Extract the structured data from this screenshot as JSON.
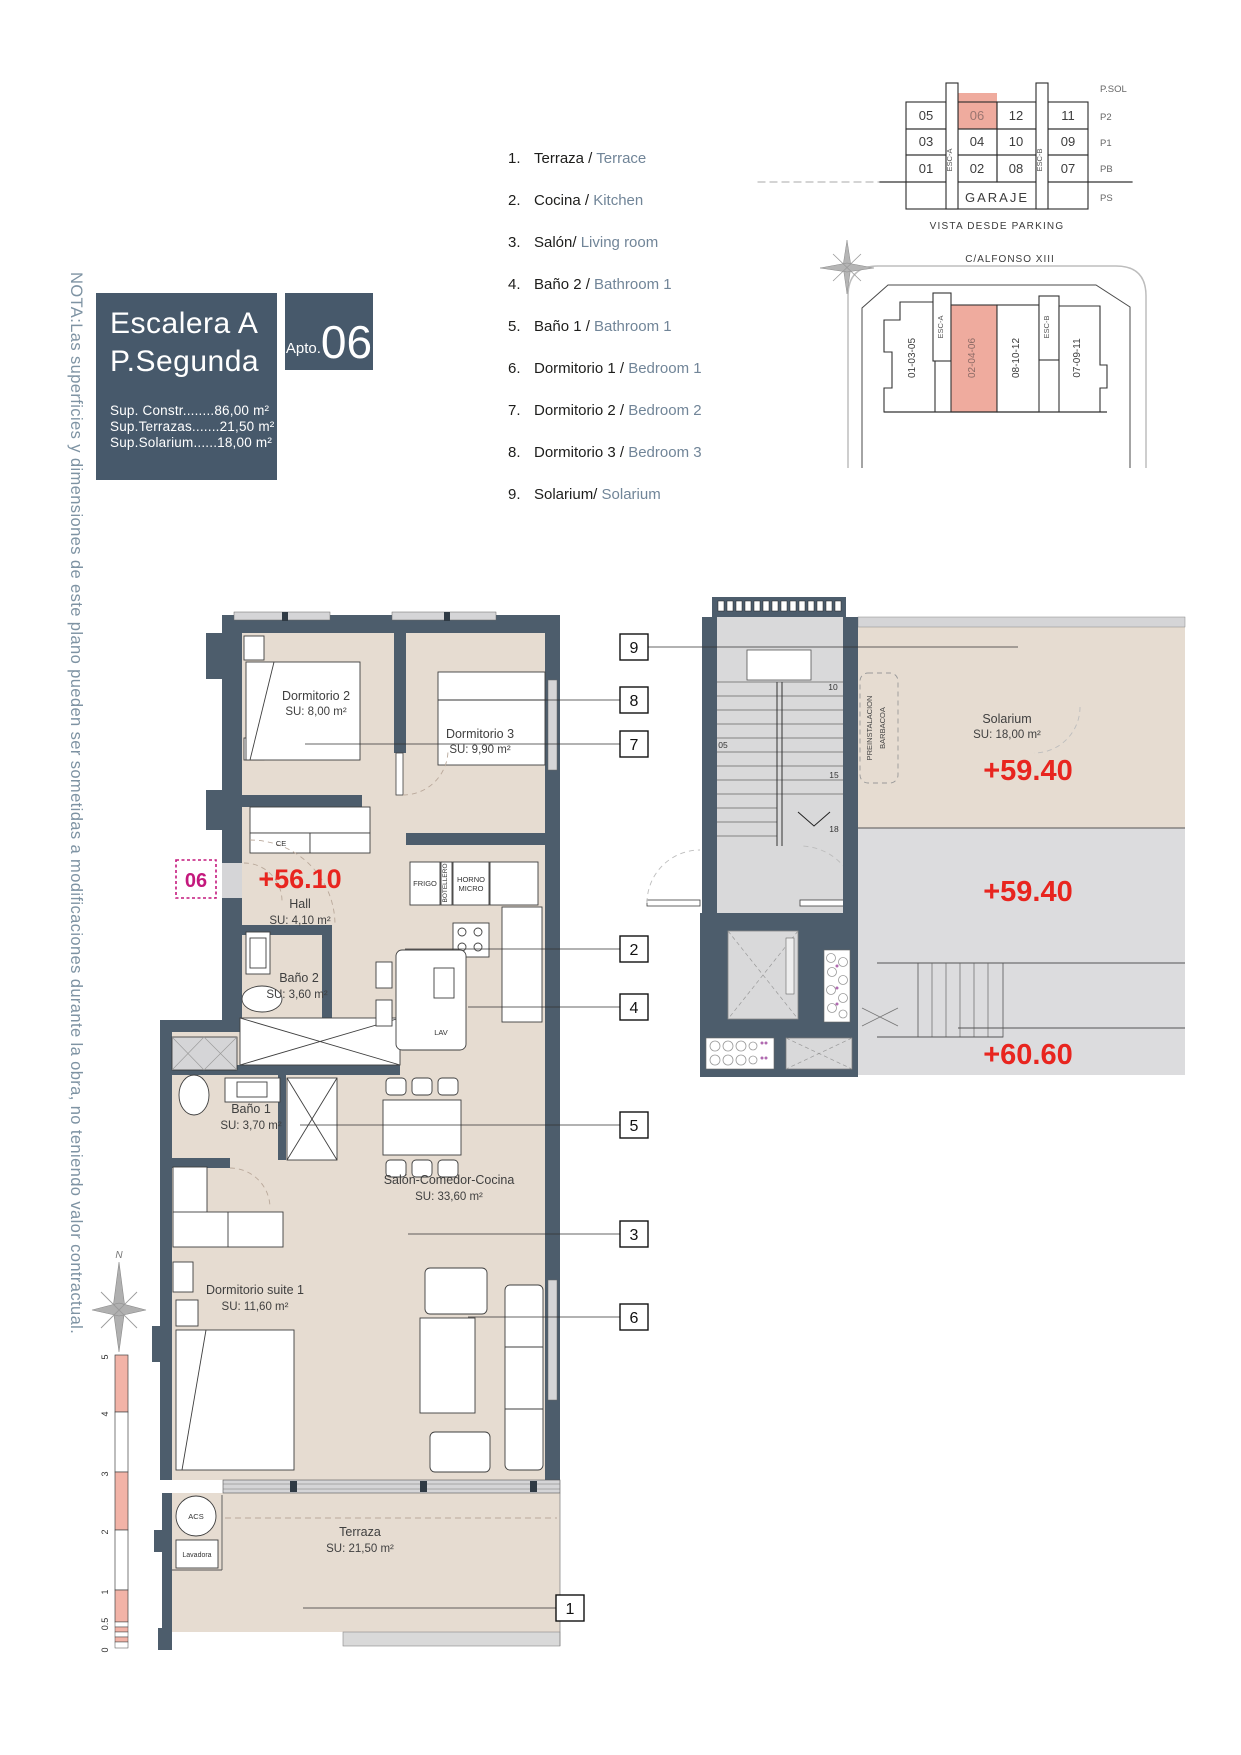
{
  "colors": {
    "accent_dark": "#47596b",
    "wall": "#4d5d6c",
    "floor_beige": "#e6dcd1",
    "common_gray": "#d9d9da",
    "window_gray": "#d5d5d7",
    "highlight_salmon": "#efab9e",
    "elevation_red": "#e8251f",
    "unit_magenta": "#c4197d",
    "note_blue": "#7e93a3",
    "legend_en_blue": "#718598"
  },
  "note": "NOTA:Las superficies y dimensiones de este plano pueden ser sometidas a modificaciones durante la obra, no teniendo valor contractual.",
  "title_block": {
    "line1": "Escalera A",
    "line2": "P.Segunda",
    "apto_label": "Apto.",
    "apto_number": "06",
    "sup_constr": "Sup. Constr........86,00 m²",
    "sup_terrazas": "Sup.Terrazas.......21,50 m²",
    "sup_solarium": "Sup.Solarium......18,00 m²"
  },
  "legend": {
    "items": [
      {
        "num": "1.",
        "es": "Terraza / ",
        "en": "Terrace"
      },
      {
        "num": "2.",
        "es": "Cocina / ",
        "en": "Kitchen"
      },
      {
        "num": "3.",
        "es": "Salón/ ",
        "en": "Living room"
      },
      {
        "num": "4.",
        "es": "Baño 2 / ",
        "en": "Bathroom 1"
      },
      {
        "num": "5.",
        "es": "Baño 1 / ",
        "en": "Bathroom 1"
      },
      {
        "num": "6.",
        "es": "Dormitorio 1 / ",
        "en": "Bedroom 1"
      },
      {
        "num": "7.",
        "es": "Dormitorio 2 / ",
        "en": "Bedroom 2"
      },
      {
        "num": "8.",
        "es": "Dormitorio 3 / ",
        "en": "Bedroom 3"
      },
      {
        "num": "9.",
        "es": "Solarium/ ",
        "en": "Solarium"
      }
    ]
  },
  "parking_diagram": {
    "caption": "VISTA DESDE PARKING",
    "garage": "GARAJE",
    "esc_a": "ESC-A",
    "esc_b": "ESC-B",
    "highlighted_unit": "06",
    "floor_labels": [
      "P.SOL",
      "P2",
      "P1",
      "PB",
      "PS"
    ],
    "rows": [
      [
        "05",
        "06",
        "12",
        "11"
      ],
      [
        "03",
        "04",
        "10",
        "09"
      ],
      [
        "01",
        "02",
        "08",
        "07"
      ]
    ]
  },
  "site_plan": {
    "street": "C/ALFONSO XIII",
    "block1": "01-03-05",
    "block2": "02-04-06",
    "block3": "08-10-12",
    "block4": "07-09-11",
    "esc_a": "ESC-A",
    "esc_b": "ESC-B",
    "highlighted_block": "02-04-06"
  },
  "plan": {
    "rooms": {
      "dorm2": {
        "name": "Dormitorio 2",
        "area": "SU: 8,00 m²"
      },
      "dorm3": {
        "name": "Dormitorio 3",
        "area": "SU: 9,90 m²"
      },
      "hall": {
        "name": "Hall",
        "area": "SU: 4,10 m²"
      },
      "bano2": {
        "name": "Baño 2",
        "area": "SU: 3,60 m²"
      },
      "bano1": {
        "name": "Baño 1",
        "area": "SU: 3,70 m²"
      },
      "suite": {
        "name": "Dormitorio suite 1",
        "area": "SU: 11,60 m²"
      },
      "salon": {
        "name": "Salón-Comedor-Cocina",
        "area": "SU: 33,60 m²"
      },
      "terraza": {
        "name": "Terraza",
        "area": "SU: 21,50 m²"
      },
      "solarium": {
        "name": "Solarium",
        "area": "SU: 18,00 m²"
      }
    },
    "elevations": {
      "hall": "+56.10",
      "solarium": "+59.40",
      "landing": "+59.40",
      "upper": "+60.60"
    },
    "labels": {
      "ce": "CE",
      "frigo": "FRIGO",
      "botellero": "BOTELLERO",
      "horno1": "HORNO",
      "horno2": "MICRO",
      "lav": "LAV",
      "acs": "ACS",
      "lavadora": "Lavadora",
      "barbacoa1": "PREINSTALACION",
      "barbacoa2": "BARBACOA"
    },
    "stair_numbers": [
      "05",
      "10",
      "15",
      "18"
    ],
    "unit_marker": "06",
    "callouts": [
      "1",
      "2",
      "3",
      "4",
      "5",
      "6",
      "7",
      "8",
      "9"
    ],
    "compass": {
      "n": "N",
      "s": "S"
    },
    "scale_labels": [
      "5",
      "4",
      "3",
      "2",
      "1",
      "0.5",
      "0"
    ]
  }
}
